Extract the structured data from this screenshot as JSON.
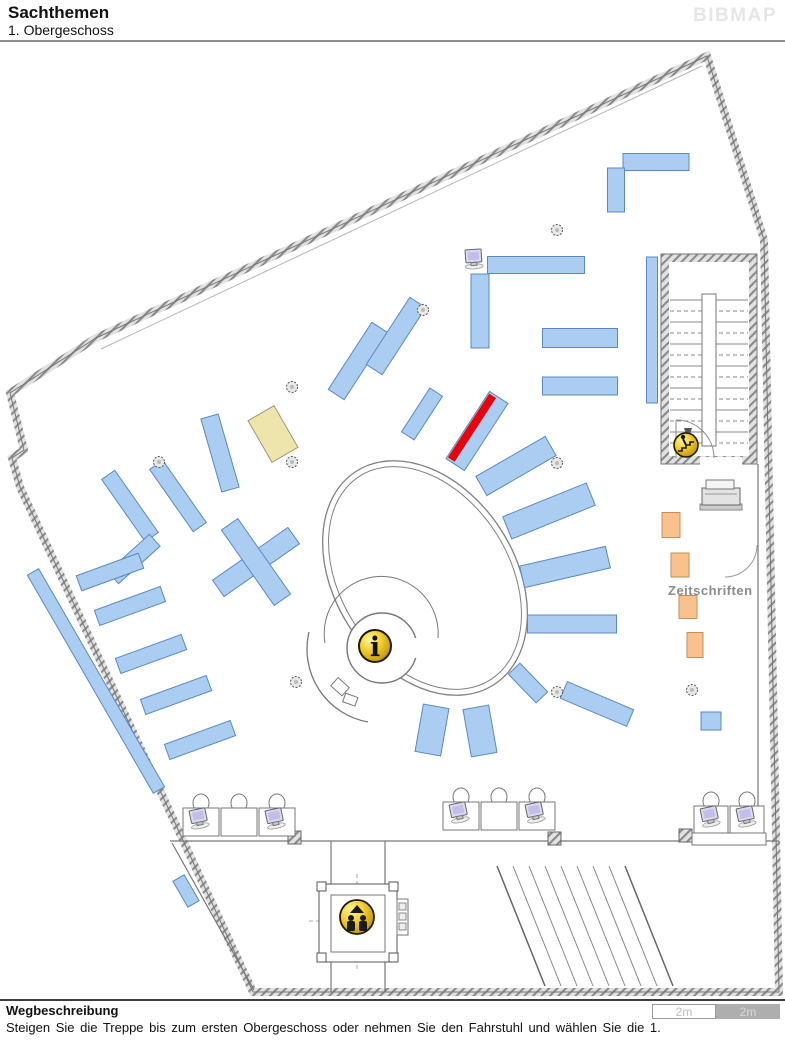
{
  "header": {
    "title": "Sachthemen",
    "subtitle": "1. Obergeschoss",
    "logo": "BIBMAP"
  },
  "footer": {
    "heading": "Wegbeschreibung",
    "text": "Steigen Sie die Treppe bis zum ersten Obergeschoss oder nehmen Sie den Fahrstuhl und wählen Sie die 1.",
    "scale": [
      "2m",
      "2m"
    ]
  },
  "map": {
    "labels": {
      "zeitschriften": "Zeitschriften",
      "info_glyph": "i"
    },
    "colors": {
      "shelf": "#ABCDF1",
      "shelf_border": "#5B88BE",
      "highlight": "#E8000B",
      "yellow": "#EDE5AC",
      "yellow_border": "#9a9a7a",
      "orange": "#F9C28C",
      "orange_border": "#C28F5E",
      "gold_icon": "#F2CD30",
      "wall": "#8a8a8a",
      "line": "#777777",
      "label_gray": "#8b8b8b",
      "monitor_screen": "#d9d9f2"
    },
    "shelves_blue": [
      [
        652,
        330,
        11,
        146,
        0
      ],
      [
        656,
        162,
        66,
        17,
        0
      ],
      [
        616,
        190,
        17,
        44,
        0
      ],
      [
        536,
        265,
        97,
        17,
        0
      ],
      [
        480,
        311,
        18,
        74,
        0
      ],
      [
        580,
        338,
        75,
        19,
        0
      ],
      [
        580,
        386,
        75,
        18,
        0
      ],
      [
        358,
        361,
        19,
        80,
        33
      ],
      [
        396,
        336,
        19,
        80,
        33
      ],
      [
        422,
        414,
        15,
        52,
        33
      ],
      [
        516,
        466,
        80,
        22,
        -30
      ],
      [
        549,
        511,
        90,
        24,
        -22
      ],
      [
        565,
        567,
        88,
        22,
        -13
      ],
      [
        572,
        624,
        89,
        18,
        0
      ],
      [
        528,
        683,
        40,
        16,
        46
      ],
      [
        597,
        704,
        72,
        18,
        23
      ],
      [
        432,
        730,
        26,
        48,
        10
      ],
      [
        480,
        731,
        26,
        48,
        -10
      ],
      [
        220,
        453,
        18,
        76,
        -16
      ],
      [
        130,
        506,
        16,
        76,
        -35
      ],
      [
        178,
        496,
        16,
        76,
        -35
      ],
      [
        134,
        559,
        16,
        56,
        48
      ],
      [
        110,
        572,
        66,
        16,
        -20
      ],
      [
        130,
        606,
        70,
        16,
        -20
      ],
      [
        151,
        654,
        70,
        16,
        -20
      ],
      [
        176,
        695,
        70,
        16,
        -20
      ],
      [
        200,
        740,
        70,
        16,
        -20
      ],
      [
        96,
        681,
        13,
        252,
        -30
      ],
      [
        186,
        891,
        13,
        30,
        -30
      ],
      [
        256,
        562,
        92,
        20,
        -35
      ],
      [
        256,
        562,
        20,
        92,
        -35
      ],
      [
        711,
        721,
        20,
        18,
        0
      ]
    ],
    "shelf_highlight": [
      477,
      431,
      22,
      80,
      33
    ],
    "shelf_yellow": [
      273,
      434,
      30,
      48,
      -30
    ],
    "shelves_orange": [
      [
        671,
        525,
        18,
        25,
        0
      ],
      [
        680,
        565,
        18,
        24,
        0
      ],
      [
        688,
        607,
        18,
        23,
        0
      ],
      [
        695,
        645,
        16,
        25,
        0
      ]
    ],
    "columns": [
      [
        159,
        462
      ],
      [
        292,
        387
      ],
      [
        292,
        462
      ],
      [
        423,
        310
      ],
      [
        557,
        230
      ],
      [
        557,
        463
      ],
      [
        557,
        692
      ],
      [
        692,
        690
      ],
      [
        296,
        682
      ]
    ],
    "bins": [
      [
        288,
        831
      ],
      [
        548,
        832
      ],
      [
        679,
        829
      ]
    ],
    "stations": [
      {
        "x": 183,
        "y": 808,
        "deskW": 36,
        "deskH": 28,
        "count": 3,
        "monitors": [
          0,
          2
        ],
        "counter": false
      },
      {
        "x": 443,
        "y": 802,
        "deskW": 36,
        "deskH": 28,
        "count": 3,
        "monitors": [
          0,
          2
        ],
        "counter": false
      },
      {
        "x": 694,
        "y": 806,
        "deskW": 34,
        "deskH": 27,
        "count": 2,
        "monitors": [
          0,
          1
        ],
        "counter": true
      }
    ],
    "single_computer": [
      465,
      250
    ],
    "icons": {
      "info": {
        "x": 375,
        "y": 646,
        "r": 16
      },
      "elevator": {
        "x": 357,
        "y": 917,
        "r": 17
      },
      "stairs": {
        "x": 686,
        "y": 445,
        "r": 12
      }
    },
    "oval": {
      "cx": 425,
      "cy": 578,
      "rx": 90,
      "ry": 127,
      "rot": -33
    },
    "zeitschriften_pos": [
      668,
      595
    ]
  }
}
